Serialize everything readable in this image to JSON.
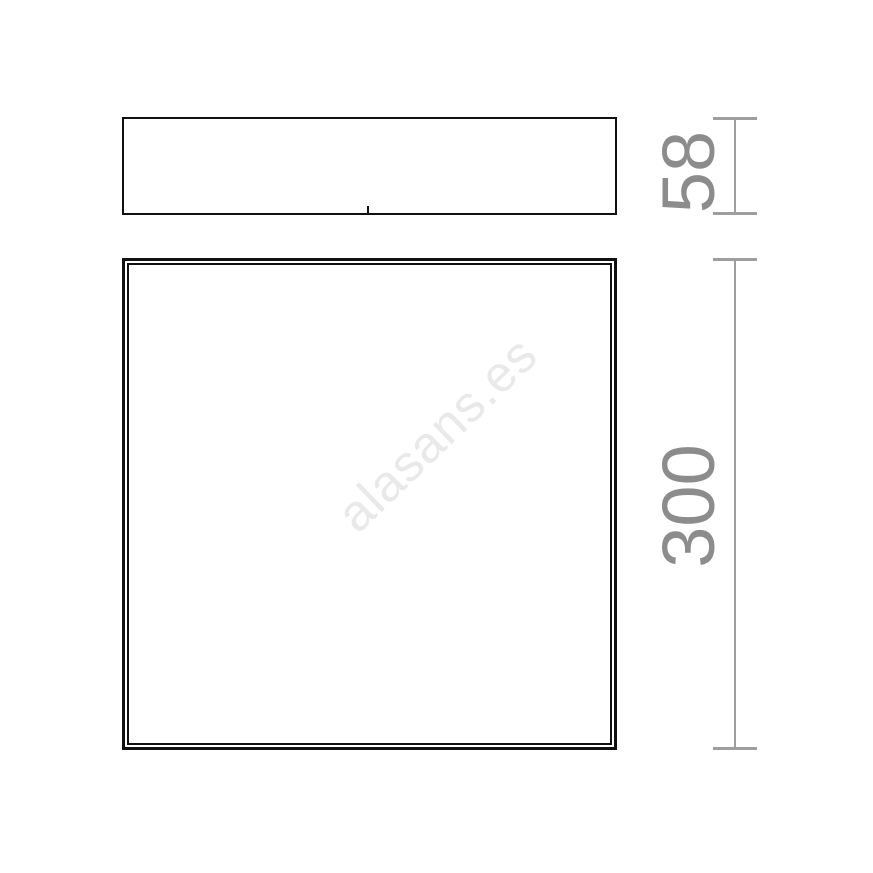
{
  "drawing": {
    "kind": "technical-dimension-drawing",
    "views": [
      {
        "id": "side-view",
        "shape": "rectangle"
      },
      {
        "id": "front-view",
        "shape": "square-double-outline"
      }
    ],
    "dimensions": [
      {
        "label": "58",
        "orientation": "vertical",
        "applies_to": "side-view"
      },
      {
        "label": "300",
        "orientation": "vertical",
        "applies_to": "front-view"
      }
    ],
    "watermark": {
      "text": "alasans.es",
      "color": "#e9e9e9"
    },
    "colors": {
      "background": "#ffffff",
      "outline": "#111111",
      "dimension_line": "#9e9e9e",
      "dimension_text": "#8c8c8c"
    }
  }
}
